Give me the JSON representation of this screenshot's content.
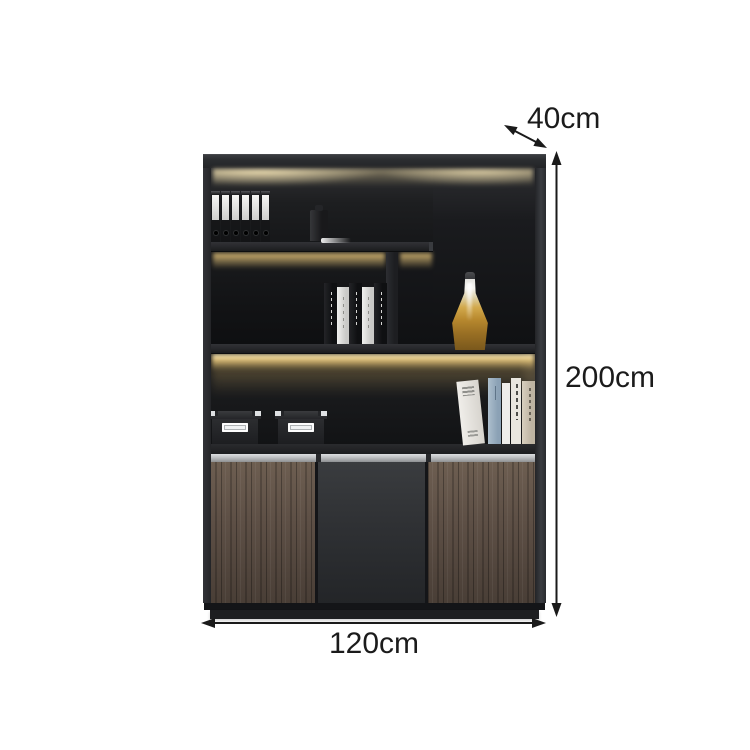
{
  "scene": {
    "description": "Product dimension diagram of a dark office display cabinet with LED-lit open shelves, decor items and wood-grain lower doors",
    "background_color": "#ffffff"
  },
  "dimensions": {
    "depth": {
      "label": "40cm"
    },
    "height": {
      "label": "200cm"
    },
    "width": {
      "label": "120cm"
    }
  },
  "cabinet": {
    "binder_count": 6,
    "middle_books": [
      "dark",
      "light",
      "dark",
      "light",
      "dark"
    ],
    "right_books": [
      "lean-white",
      "blue",
      "thin-white",
      "print-white",
      "tan"
    ],
    "storage_box_count": 2,
    "door_panels": [
      "wood",
      "dark",
      "wood"
    ],
    "colors": {
      "bg": "#ffffff",
      "frame": "#222326",
      "interior_dark": "#131416",
      "led_glow": "#f3dda0",
      "wood": "#5e5046",
      "wood_shadow": "#453a32",
      "center_door": "#2f3134",
      "handle_rail": "#c0c2c4",
      "decanter_gold": "#d2a94c",
      "dimension_ink": "#1b1b1b"
    }
  }
}
